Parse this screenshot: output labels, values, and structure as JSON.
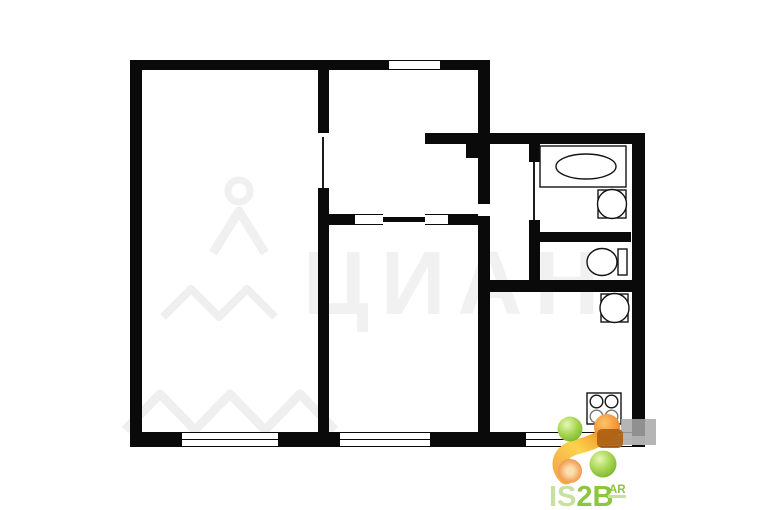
{
  "plan": {
    "type": "apartment-floor-plan",
    "wall_color": "#0a0a0a",
    "background_color": "#ffffff",
    "rooms": [
      {
        "name": "room-large-left"
      },
      {
        "name": "room-top-middle"
      },
      {
        "name": "room-bottom-middle"
      },
      {
        "name": "hallway"
      },
      {
        "name": "bathroom"
      },
      {
        "name": "toilet-room"
      },
      {
        "name": "kitchen"
      }
    ],
    "fixtures": [
      {
        "icon": "bathtub-icon"
      },
      {
        "icon": "washbasin-icon"
      },
      {
        "icon": "toilet-icon"
      },
      {
        "icon": "kitchen-sink-icon"
      },
      {
        "icon": "stove-4-burner-icon"
      }
    ]
  },
  "watermark": {
    "text": "ЦИАН",
    "color": "#f0f0f0"
  },
  "logo": {
    "text_primary": "IS",
    "text_secondary": "2B",
    "superscript": "AR",
    "color_pale_green": "#c9e1a0",
    "color_green": "#8cc63f",
    "color_orange": "#f07d1e",
    "color_yellow": "#fde68a",
    "color_brown": "#ad5f10",
    "color_gray": "#a8a8a8"
  }
}
